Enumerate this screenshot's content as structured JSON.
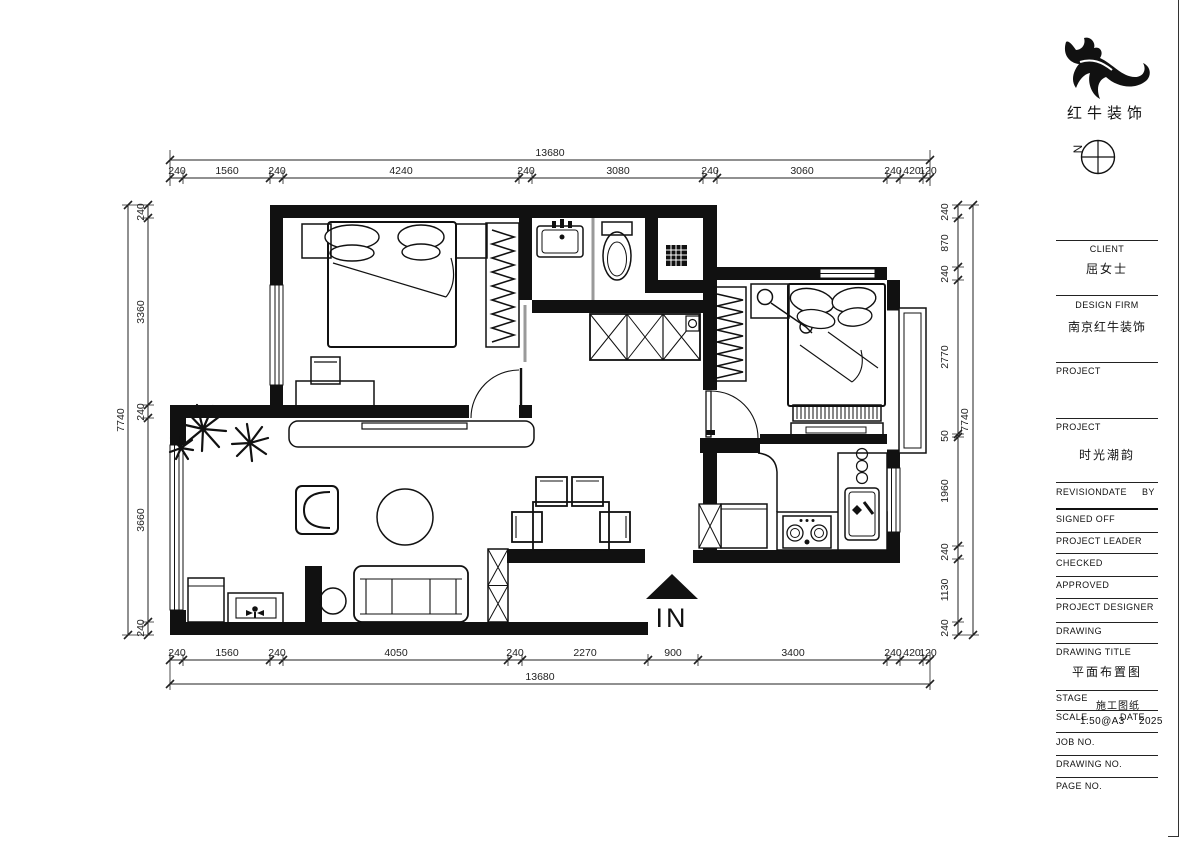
{
  "logo": {
    "brand": "红牛装饰",
    "mark": "bull-swoosh-logo"
  },
  "north": {
    "label": "N"
  },
  "plan": {
    "entrance_label": "IN"
  },
  "dims": {
    "top": {
      "total": "13680",
      "segments": [
        "240",
        "1560",
        "240",
        "4240",
        "240",
        "3080",
        "240",
        "3060",
        "240",
        "420",
        "120"
      ]
    },
    "bottom": {
      "total": "13680",
      "segments": [
        "240",
        "1560",
        "240",
        "4050",
        "240",
        "2270",
        "900",
        "3400",
        "240",
        "420",
        "120"
      ]
    },
    "left": {
      "total": "7740",
      "segments": [
        "240",
        "3360",
        "240",
        "3660",
        "240"
      ]
    },
    "right": {
      "total": "7740",
      "segments": [
        "240",
        "870",
        "240",
        "2770",
        "50",
        "1960",
        "240",
        "1130",
        "240"
      ]
    }
  },
  "title_block": {
    "client_label": "CLIENT",
    "client_value": "屈女士",
    "design_firm_label": "DESIGN FIRM",
    "design_firm_value": "南京红牛装饰",
    "project1_label": "PROJECT",
    "project2_label": "PROJECT",
    "project2_value": "时光潮韵",
    "revision_label": "REVISION",
    "date_label": "DATE",
    "by_label": "BY",
    "signed_off_label": "SIGNED OFF",
    "project_leader_label": "PROJECT LEADER",
    "checked_label": "CHECKED",
    "approved_label": "APPROVED",
    "project_designer_label": "PROJECT DESIGNER",
    "drawing_label": "DRAWING",
    "drawing_title_label": "DRAWING TITLE",
    "drawing_title_value": "平面布置图",
    "stage_label": "STAGE",
    "stage_value": "施工图纸",
    "scale_label": "SCALE",
    "scale_value": "1:50@A3",
    "date2_label": "DATE",
    "date_value": "2025",
    "job_no_label": "JOB NO.",
    "drawing_no_label": "DRAWING NO.",
    "page_no_label": "PAGE NO."
  }
}
